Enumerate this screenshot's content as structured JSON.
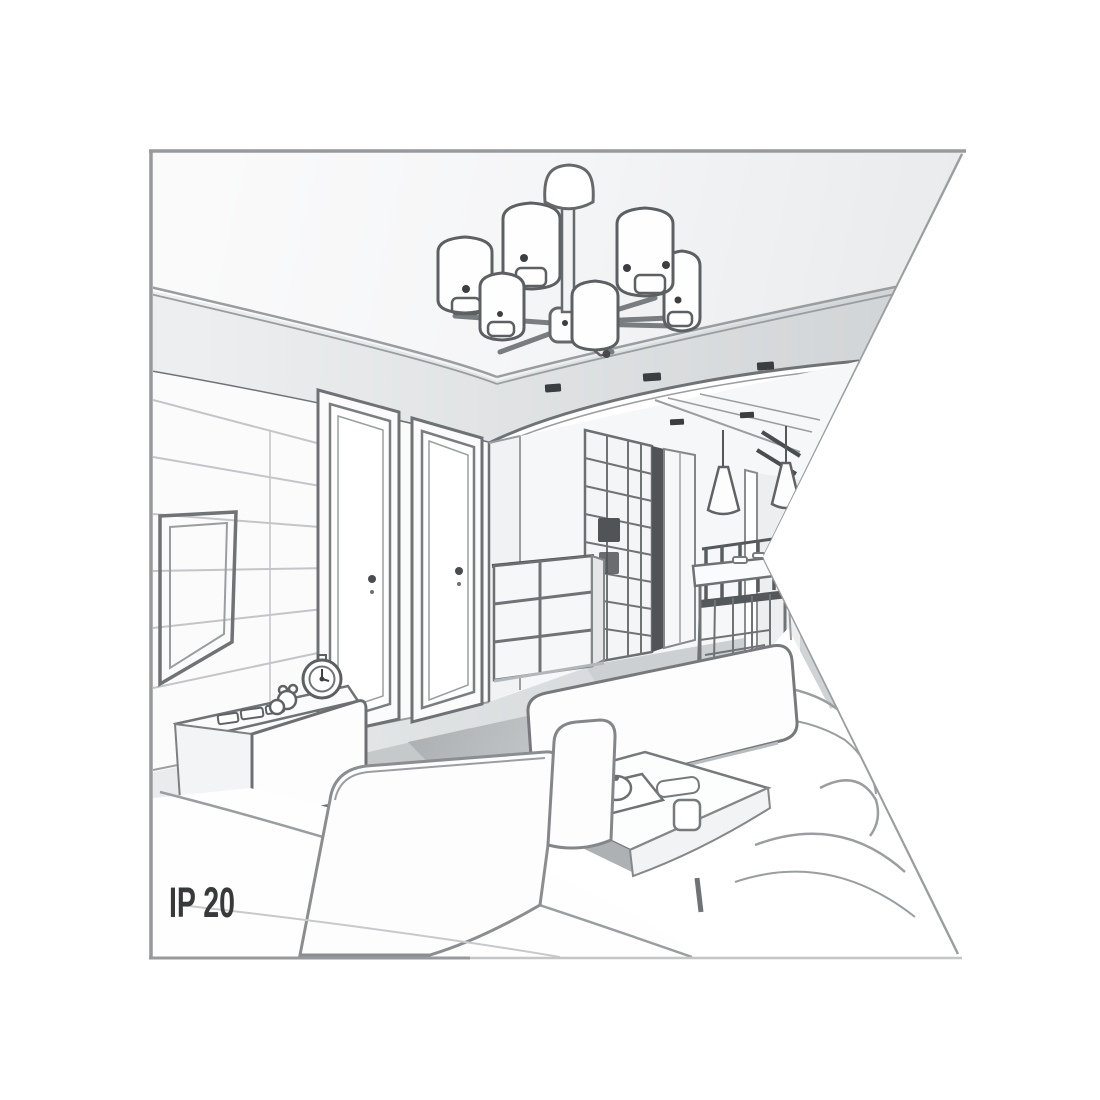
{
  "label": {
    "ip_rating": "IP 20"
  },
  "scene": {
    "description": "grayscale line-art perspective illustration of a living room interior shown as product context for a 6-shade ceiling chandelier",
    "elements": [
      "ceiling-chandelier-6-cylinder-shades",
      "tray-ceiling-with-recessed-downlights",
      "wall-mounted-tv-panel",
      "interior-door-left",
      "interior-door-right",
      "grid-front-wardrobe",
      "chest-of-drawers",
      "cone-pendant-lights",
      "dining-table-with-chairs",
      "tv-sideboard",
      "alarm-clock",
      "toy-figure",
      "sofa-back-cushion",
      "coffee-table-with-tray-teapot-cups",
      "foreground-armchair"
    ]
  },
  "colors": {
    "background": "#ffffff",
    "frame": "#97999c",
    "line_dark": "#55585b",
    "line": "#707376",
    "line_soft": "#9b9ea1",
    "panel_line": "#c3c5c7",
    "ceiling_shade": "#d3d6d8",
    "soffit": "#dfe2e3",
    "wall": "#fbfbfc",
    "floor": "#dfe1e2",
    "floor_dark": "#ced1d3",
    "shadow": "#b6b9bb",
    "downlight": "#3b3e40",
    "dark_panel": "#515457",
    "text": "#37393b",
    "white": "#ffffff"
  }
}
